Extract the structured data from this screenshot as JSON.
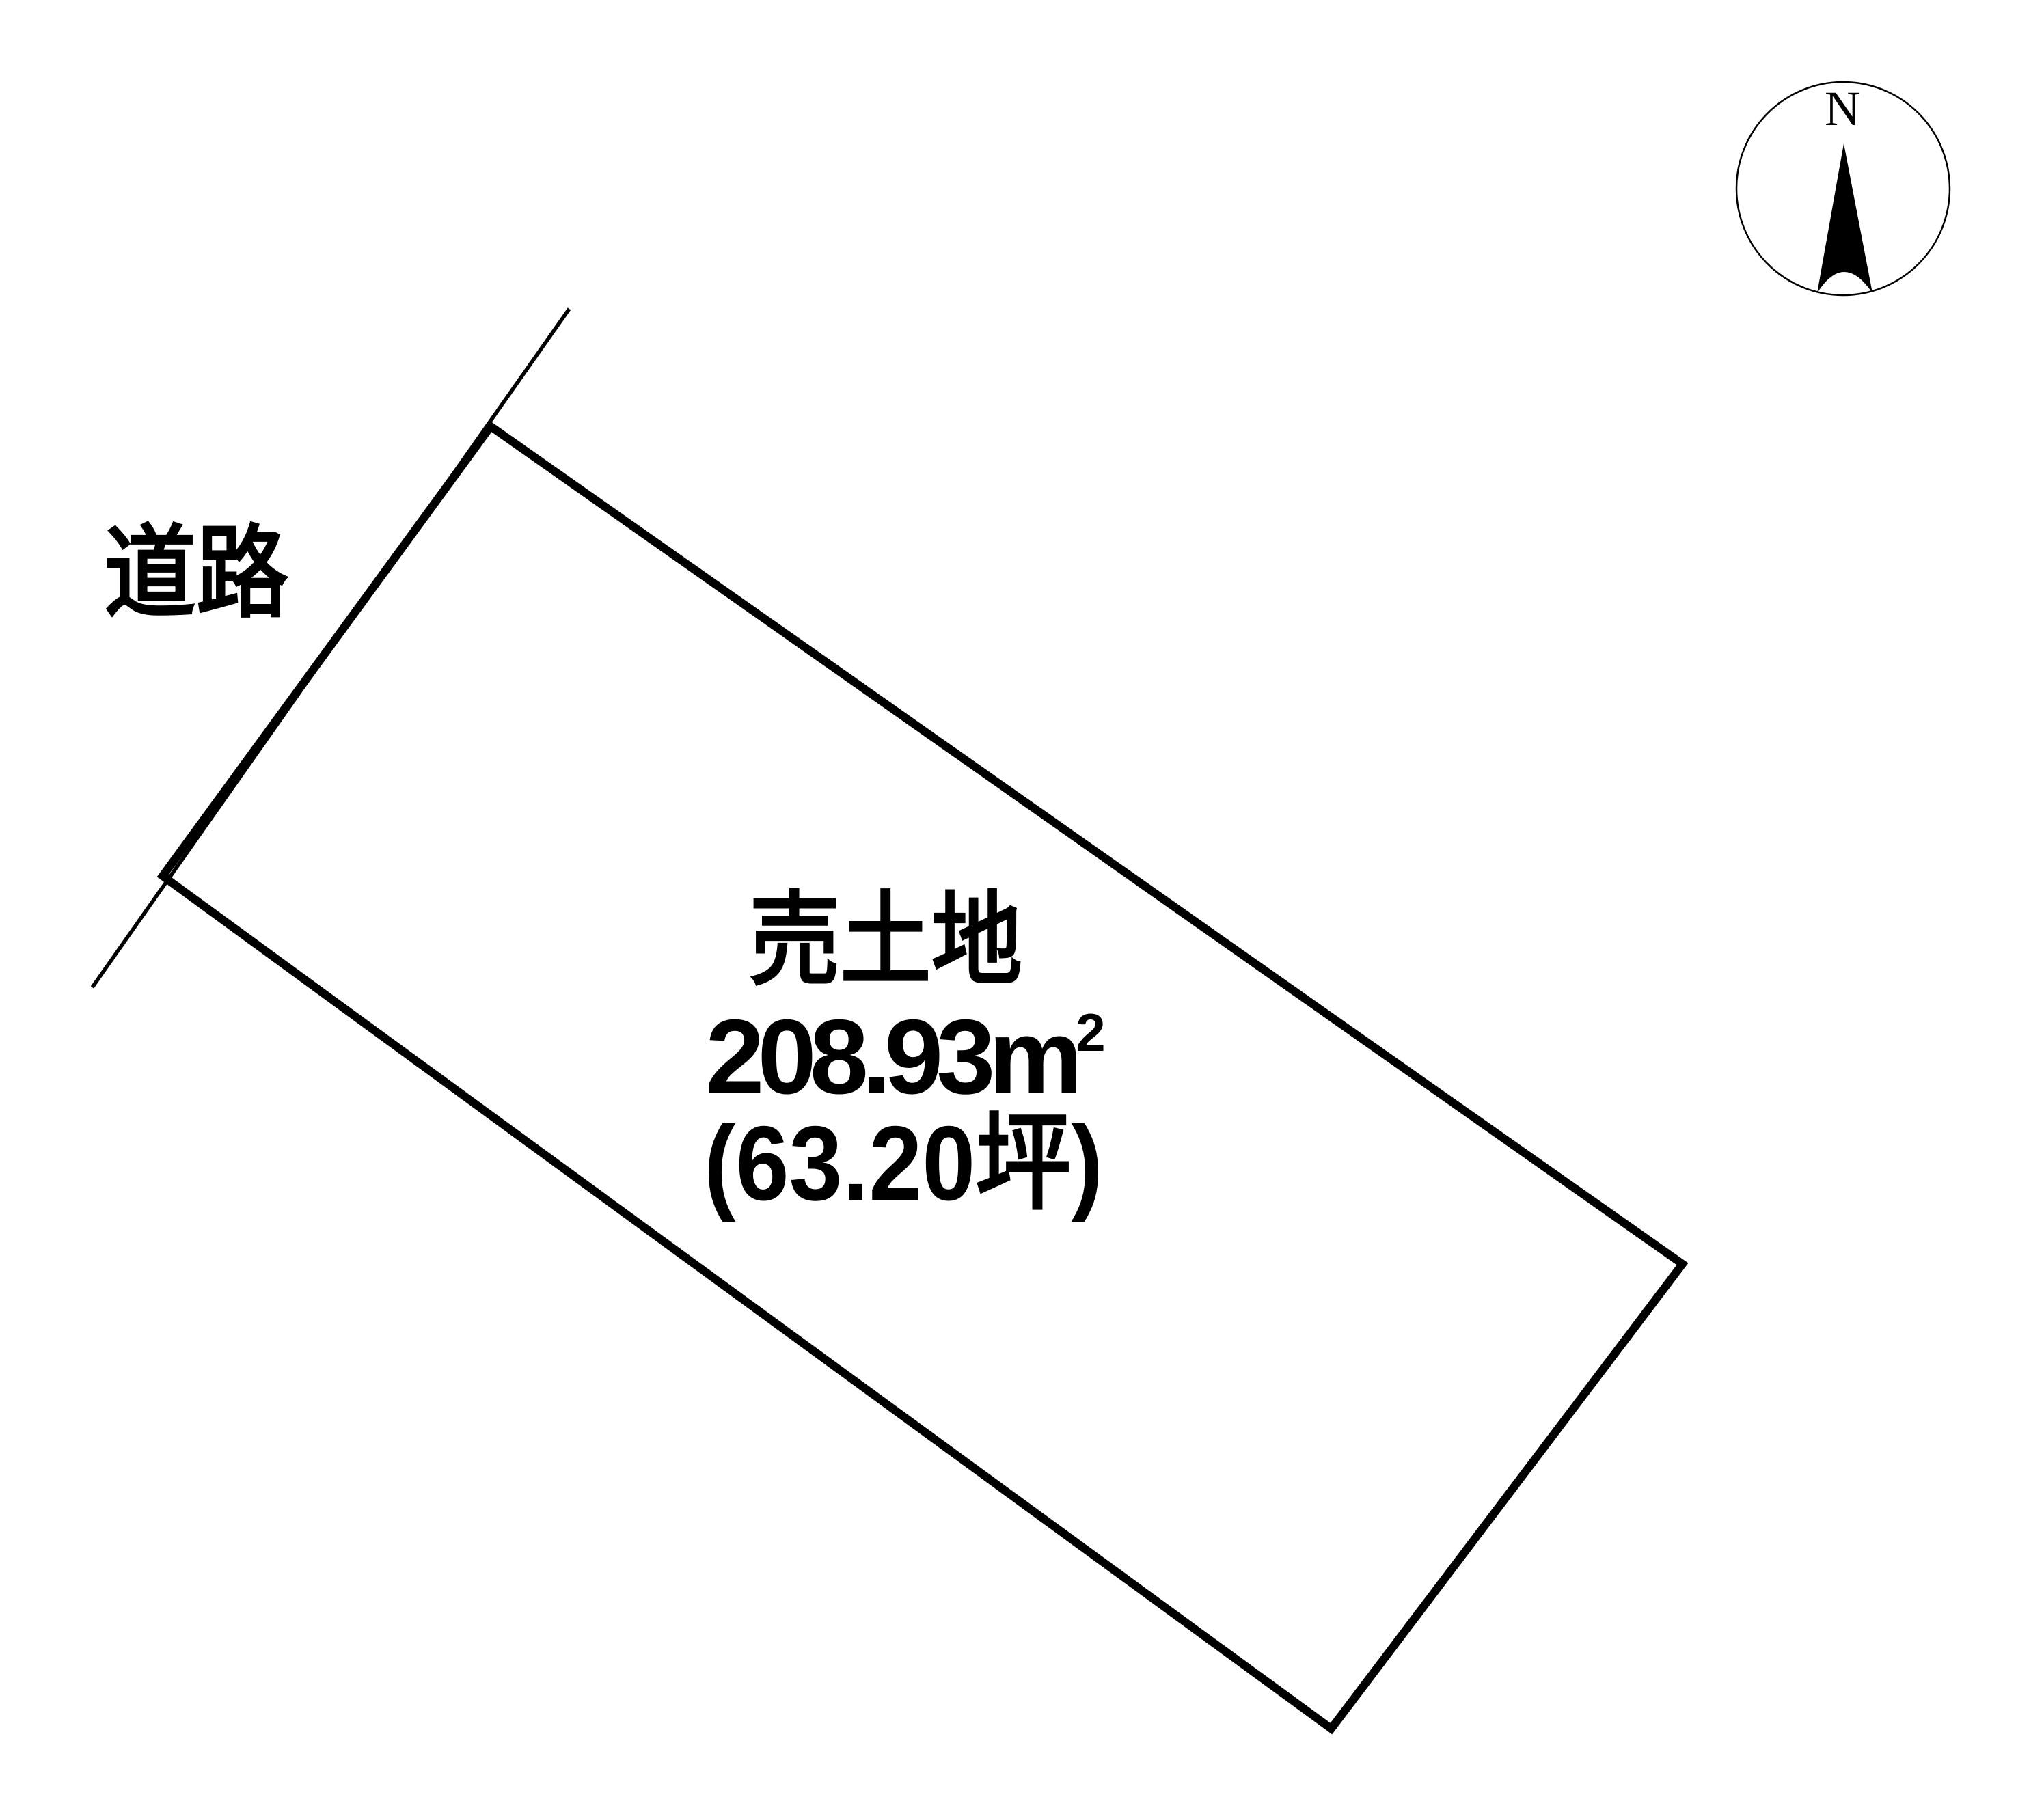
{
  "diagram": {
    "road": {
      "label": "道路"
    },
    "parcel": {
      "title": "売土地",
      "area_value": "208.93",
      "area_unit": "m",
      "area_unit_exponent": "2",
      "area_sqm_display": "208.93m²",
      "area_tsubo": "(63.20坪)"
    },
    "compass": {
      "north_label": "N"
    }
  },
  "colors": {
    "ink": "#000000",
    "background": "#ffffff"
  }
}
